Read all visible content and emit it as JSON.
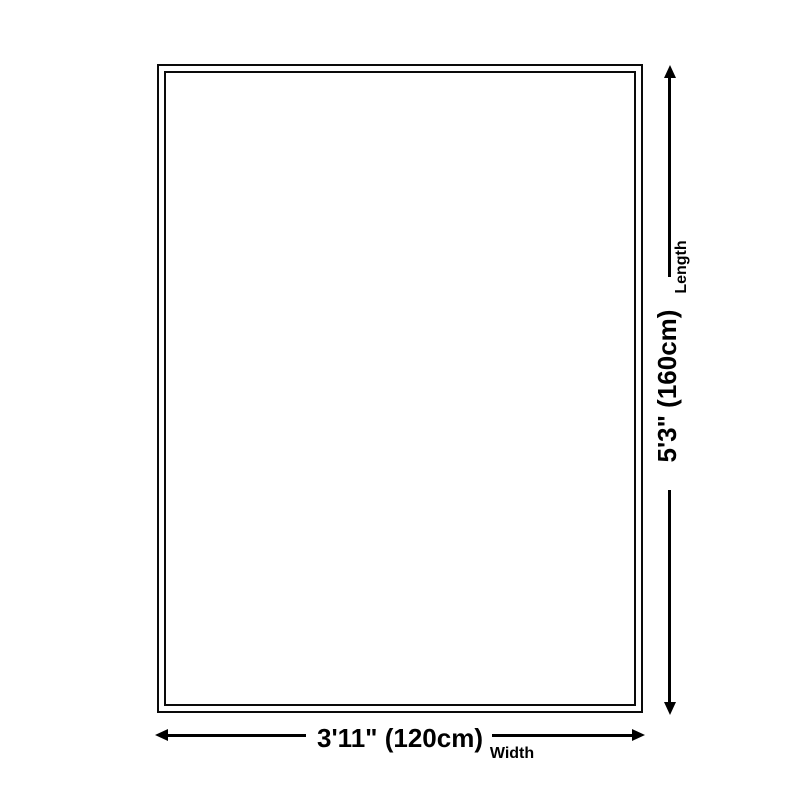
{
  "diagram": {
    "type": "product-dimensions",
    "subject": "rug outline",
    "background_color": "#ffffff",
    "line_color": "#000000",
    "dimensions": {
      "length": {
        "value": "5'3\" (160cm)",
        "label": "Length",
        "orientation": "vertical"
      },
      "width": {
        "value": "3'11\" (120cm)",
        "label": "Width",
        "orientation": "horizontal"
      }
    }
  }
}
